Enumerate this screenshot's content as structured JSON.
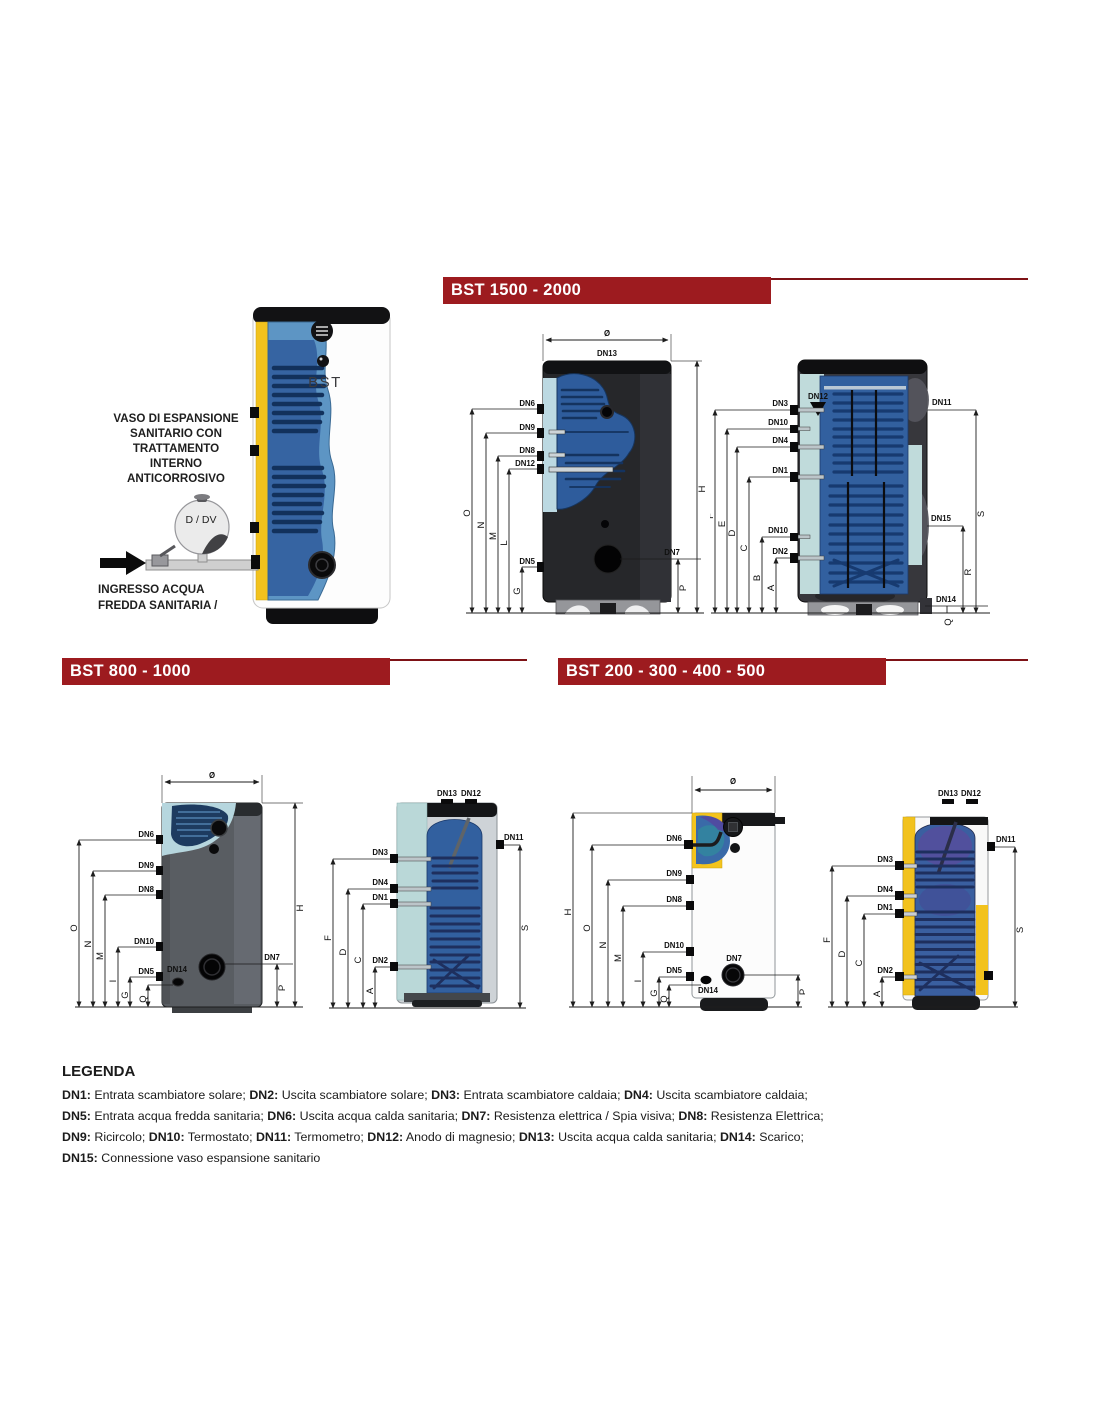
{
  "sections": [
    {
      "title": "BST 1500 - 2000"
    },
    {
      "title": "BST 800 - 1000"
    },
    {
      "title": "BST 200 - 300 - 400 - 500"
    }
  ],
  "colors": {
    "header_bg": "#9D1B1F",
    "header_text": "#FFFFFF",
    "rule_red": "#7E1216",
    "insulation_yellow": "#F2C21D",
    "coil_blue": "#32609F",
    "lining_teal": "#C0DBDB"
  },
  "illustration": {
    "product_label": "BST",
    "vessel_label": "D / DV",
    "expansion_note": [
      "VASO DI ESPANSIONE",
      "SANITARIO CON",
      "TRATTAMENTO",
      "INTERNO",
      "ANTICORROSIVO"
    ],
    "inlet_note": [
      "INGRESSO ACQUA",
      "FREDDA SANITARIA /"
    ]
  },
  "ports": {
    "dn1": "DN1",
    "dn2": "DN2",
    "dn3": "DN3",
    "dn4": "DN4",
    "dn5": "DN5",
    "dn6": "DN6",
    "dn7": "DN7",
    "dn8": "DN8",
    "dn9": "DN9",
    "dn10": "DN10",
    "dn11": "DN11",
    "dn12": "DN12",
    "dn13": "DN13",
    "dn14": "DN14",
    "dn15": "DN15"
  },
  "dims": {
    "dia": "Ø",
    "A": "A",
    "B": "B",
    "C": "C",
    "D": "D",
    "E": "E",
    "F": "F",
    "G": "G",
    "H": "H",
    "I": "I",
    "L": "L",
    "M": "M",
    "N": "N",
    "O": "O",
    "P": "P",
    "Q": "Q",
    "R": "R",
    "S": "S"
  },
  "legend": {
    "title": "LEGENDA",
    "lines": [
      [
        {
          "k": "DN1:",
          "t": " Entrata scambiatore solare; "
        },
        {
          "k": "DN2:",
          "t": " Uscita scambiatore solare; "
        },
        {
          "k": "DN3:",
          "t": " Entrata scambiatore caldaia; "
        },
        {
          "k": "DN4:",
          "t": " Uscita scambiatore caldaia;"
        }
      ],
      [
        {
          "k": "DN5:",
          "t": " Entrata acqua fredda sanitaria; "
        },
        {
          "k": "DN6:",
          "t": " Uscita acqua calda sanitaria; "
        },
        {
          "k": "DN7:",
          "t": " Resistenza elettrica / Spia visiva; "
        },
        {
          "k": "DN8:",
          "t": " Resistenza Elettrica;"
        }
      ],
      [
        {
          "k": "DN9:",
          "t": " Ricircolo; "
        },
        {
          "k": "DN10:",
          "t": " Termostato; "
        },
        {
          "k": "DN11:",
          "t": " Termometro; "
        },
        {
          "k": "DN12:",
          "t": " Anodo di magnesio; "
        },
        {
          "k": "DN13:",
          "t": " Uscita acqua calda sanitaria; "
        },
        {
          "k": "DN14:",
          "t": " Scarico;"
        }
      ],
      [
        {
          "k": "DN15:",
          "t": " Connessione vaso espansione sanitario"
        }
      ]
    ]
  }
}
